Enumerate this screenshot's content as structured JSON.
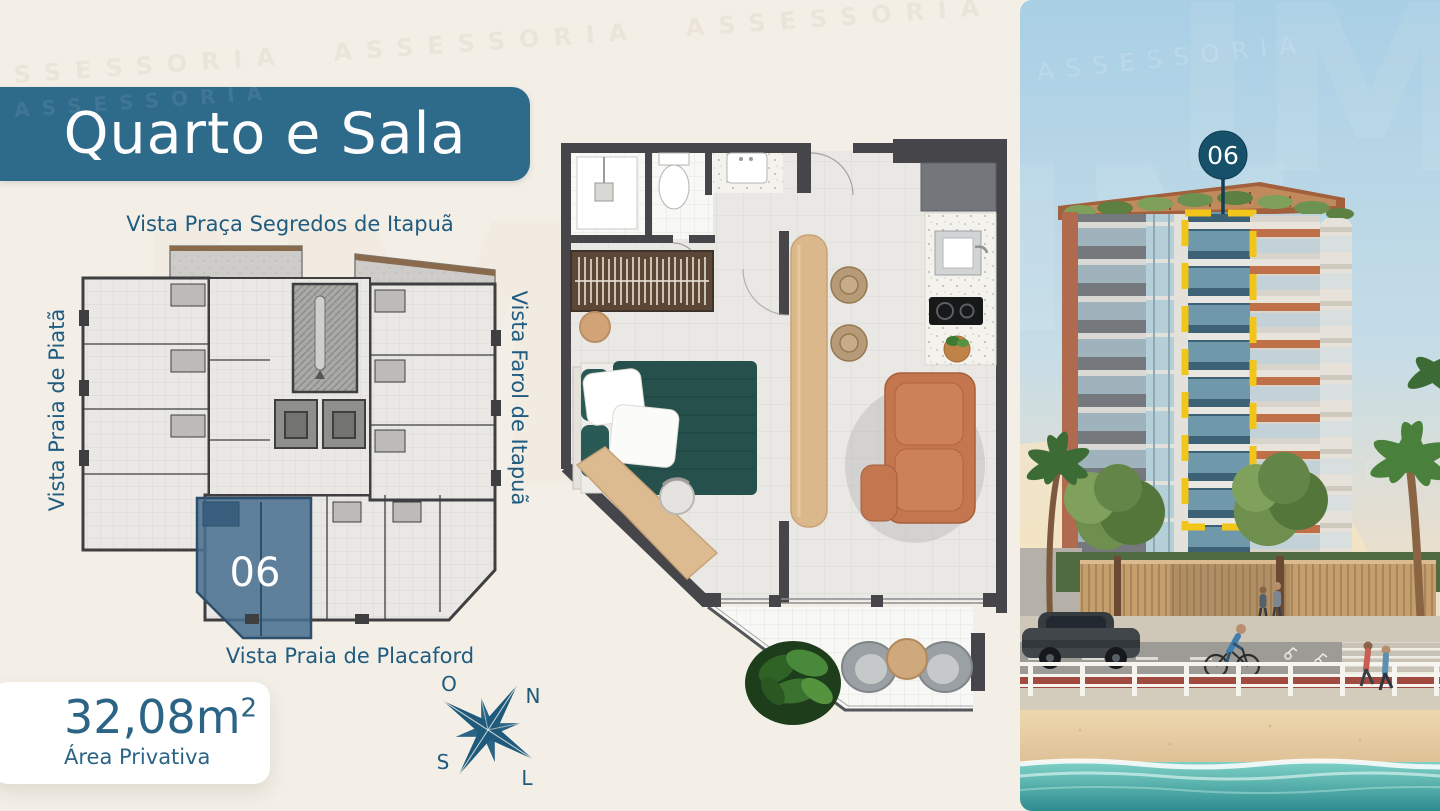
{
  "title": {
    "label": "Quarto e Sala"
  },
  "views": {
    "top": "Vista Praça Segredos de Itapuã",
    "left": "Vista Praia de Piatã",
    "right": "Vista Farol de Itapuã",
    "bottom": "Vista Praia de Placaford"
  },
  "unit": {
    "number": "06"
  },
  "area": {
    "value": "32,08m",
    "exponent": "2",
    "label": "Área Privativa"
  },
  "compass": {
    "west": "O",
    "north": "N",
    "south": "S",
    "east": "L"
  },
  "watermark": {
    "brand": "ASSESSORIA",
    "ghost": "IM"
  },
  "colors": {
    "banner_teal": "#2e6a8a",
    "label_blue": "#1f5c80",
    "unit_highlight": "#4a7191",
    "marker_teal": "#165069",
    "highlight_yellow": "#f2c51a"
  }
}
